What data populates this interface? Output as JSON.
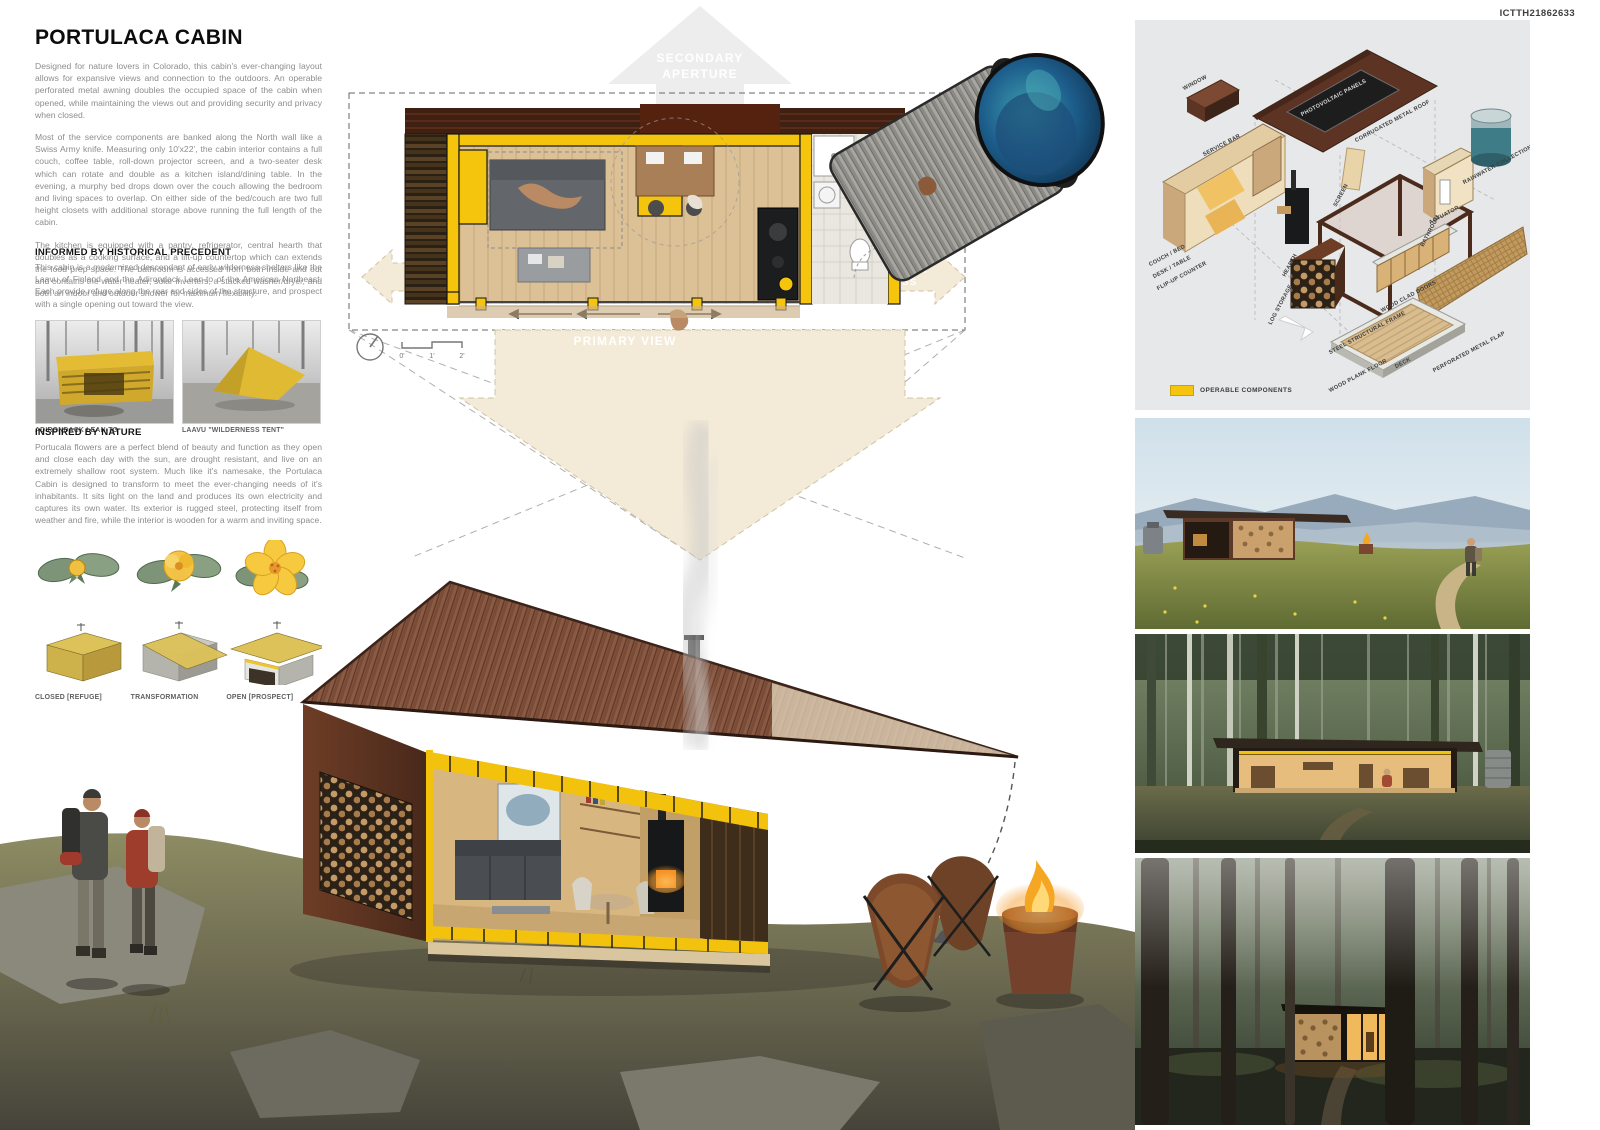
{
  "board": {
    "id": "ICTTH21862633"
  },
  "intro": {
    "title": "PORTULACA CABIN",
    "paragraphs": [
      "Designed for nature lovers in Colorado, this cabin's ever-changing layout allows for expansive views and connection to the outdoors.  An operable perforated metal awning doubles the occupied space of the cabin when opened, while maintaining the views out and providing security and privacy when closed.",
      "Most of the service components are banked along the North wall like a Swiss Army knife.  Measuring only 10'x22', the cabin interior contains a full couch, coffee table, roll-down projector screen, and a two-seater desk which can rotate and double as a kitchen island/dining table.  In the evening, a murphy bed drops down over the couch allowing the bedroom and living spaces to overlap.  On either side of the bed/couch are two full height closets with additional storage above running the full length of the cabin.",
      "The kitchen is equipped with a pantry, refrigerator, central hearth that doubles as a cooking surface, and a lift-up countertop which can extends the food prep space.  The bathroom is accessed from both inside and out and contains the water heater, solar inverters, a stacked washer/dryer, and both an indoor and outdoor shower for maximum flexibility."
    ]
  },
  "precedent": {
    "heading": "INFORMED BY HISTORICAL PRECEDENT",
    "body": "This cabin is a modernized descendant of early wilderness shelters like the Laavu of Finland and the Adirondack Lean-to of the American Northeast.  Each provide refuge along the rear and sides of the structure, and prospect with a single opening out toward the view.",
    "photos": [
      {
        "caption": "ADIRONDACK LEAN-TO"
      },
      {
        "caption": "LAAVU \"WILDERNESS TENT\""
      }
    ]
  },
  "nature": {
    "heading": "INSPIRED BY NATURE",
    "body": "Portucala flowers are a perfect blend of beauty and function as they open and close each day with the sun, are drought resistant, and live on an extremely shallow root system.  Much like it's namesake, the Portulaca Cabin is designed to transform to meet the ever-changing needs of it's inhabitants.  It sits light on the land and produces its own electricity and captures its own water. Its exterior is rugged steel, protecting itself from weather and fire, while the interior is wooden for a warm and inviting space.",
    "stages": [
      "CLOSED [REFUGE]",
      "TRANSFORMATION",
      "OPEN [PROSPECT]"
    ]
  },
  "plan": {
    "labels": {
      "secondary_aperture": [
        "SECONDARY",
        "APERTURE"
      ],
      "primary_entry": [
        "PRIMARY",
        "ENTRY"
      ],
      "secondary_access": [
        "SECONDARY",
        "ACCESS"
      ],
      "primary_view": "PRIMARY VIEW"
    },
    "scale": [
      "0'",
      "1'",
      "2'"
    ]
  },
  "axon": {
    "labels": [
      "WINDOW",
      "SERVICE BAR",
      "PHOTOVOLTAIC PANELS",
      "CORRUGATED METAL ROOF",
      "SCREEN",
      "HEARTH",
      "BATHROOM",
      "RAINWATER COLLECTION",
      "COUCH / BED",
      "DESK / TABLE",
      "FLIP-UP COUNTER",
      "LOG STORAGE",
      "STEEL STRUCTURAL FRAME",
      "ACTUATOR",
      "WOOD CLAD DOORS",
      "PERFORATED METAL FLAP",
      "WOOD PLANK FLOOR",
      "DECK"
    ],
    "legend": "OPERABLE COMPONENTS"
  },
  "colors": {
    "accent_yellow": "#F5C50E",
    "corten_steel": "#5E3322",
    "roof_brown": "#3F2012",
    "wood_floor": "#DCC096",
    "arrow_tan": "#F3EAD7"
  }
}
